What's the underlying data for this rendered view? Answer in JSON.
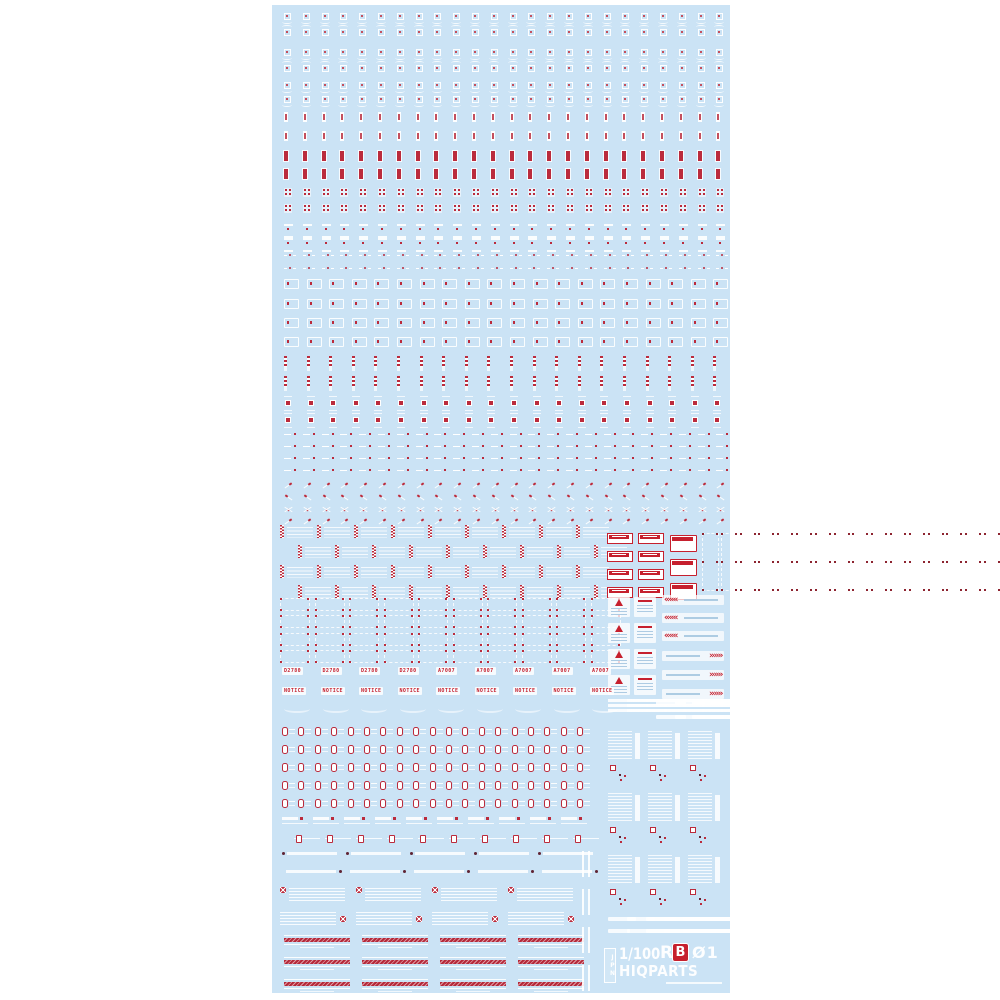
{
  "product": {
    "scale": "1/100",
    "series_r": "R",
    "series_b": "B",
    "number": "Ø1",
    "brand": "HIQPARTS",
    "region": "JPN"
  },
  "palette": {
    "page_bg": "#ffffff",
    "sheet_bg": "#cbe3f5",
    "caution_red": "#bb2b3c",
    "plate_red": "#c6202e",
    "halftone_pink": "#dd9aa2",
    "dark_dot": "#5f2433",
    "decal_white": "#ffffff"
  },
  "part_labels": {
    "code_1": "D2780",
    "code_2": "A7007",
    "notice": "NOTICE"
  },
  "decal_rows": [
    {
      "t": "tA",
      "y": 8
    },
    {
      "t": "tB",
      "y": 24
    },
    {
      "t": "tA",
      "y": 44
    },
    {
      "t": "tB",
      "y": 60
    },
    {
      "t": "tA",
      "y": 77
    },
    {
      "t": "tA",
      "y": 91
    },
    {
      "t": "tBar",
      "y": 107
    },
    {
      "t": "tBar",
      "y": 126
    },
    {
      "t": "tRedBar",
      "y": 146
    },
    {
      "t": "tRedBar",
      "y": 164
    },
    {
      "t": "tQuad",
      "y": 183
    },
    {
      "t": "tQuad",
      "y": 199
    },
    {
      "t": "tBand",
      "y": 219
    },
    {
      "t": "tBand",
      "y": 233
    },
    {
      "t": "tDotWing",
      "y": 248
    },
    {
      "t": "tDotWing",
      "y": 261
    },
    {
      "t": "tBoxTick",
      "y": 274,
      "n": 20,
      "dx": 22.6
    },
    {
      "t": "tBoxTick",
      "y": 294,
      "n": 20,
      "dx": 22.6
    },
    {
      "t": "tBoxTick",
      "y": 313,
      "n": 20,
      "dx": 22.6
    },
    {
      "t": "tBoxTick",
      "y": 332,
      "n": 20,
      "dx": 22.6
    },
    {
      "t": "tZig",
      "y": 351,
      "n": 20,
      "dx": 22.6
    },
    {
      "t": "tZig",
      "y": 371,
      "n": 20,
      "dx": 22.6
    },
    {
      "t": "tRedSq",
      "y": 391,
      "n": 20,
      "dx": 22.6
    },
    {
      "t": "tRedSq",
      "y": 408,
      "n": 20,
      "dx": 22.6
    },
    {
      "t": "tDashDot",
      "y": 427
    },
    {
      "t": "tDashDot",
      "y": 439
    },
    {
      "t": "tDashDot",
      "y": 451
    },
    {
      "t": "tDashDot",
      "y": 463
    },
    {
      "t": "tSlash",
      "y": 477
    },
    {
      "t": "tSlash2",
      "y": 489
    },
    {
      "t": "tX",
      "y": 501
    },
    {
      "t": "tSlash",
      "y": 513
    },
    {
      "t": "caution",
      "x": 8,
      "y": 520,
      "n": 9,
      "dx": 37
    },
    {
      "t": "caution",
      "x": 26,
      "y": 540,
      "n": 9,
      "dx": 37
    },
    {
      "t": "caution",
      "x": 8,
      "y": 560,
      "n": 9,
      "dx": 37
    },
    {
      "t": "caution",
      "x": 26,
      "y": 580,
      "n": 9,
      "dx": 37
    },
    {
      "t": "plateS",
      "x": 335,
      "y": 528,
      "n": 4,
      "dy": 18
    },
    {
      "t": "plateS",
      "x": 366,
      "y": 528,
      "n": 4,
      "dy": 18
    },
    {
      "t": "plateL",
      "x": 398,
      "y": 530,
      "n": 3,
      "dy": 24
    },
    {
      "t": "dframeV",
      "x": 430,
      "y": 528
    },
    {
      "t": "dframe",
      "x": 8,
      "y": 593,
      "n": 10,
      "dx": 34.5
    },
    {
      "t": "dframe",
      "x": 8,
      "y": 610,
      "n": 10,
      "dx": 34.5
    },
    {
      "t": "dframe",
      "x": 8,
      "y": 628,
      "n": 10,
      "dx": 34.5
    },
    {
      "t": "dframe",
      "x": 8,
      "y": 645,
      "n": 10,
      "dx": 34.5
    },
    {
      "t": "triPanel",
      "x": 336,
      "y": 592,
      "n": 4,
      "dy": 26
    },
    {
      "t": "linePanel",
      "x": 362,
      "y": 592,
      "n": 4,
      "dy": 26
    },
    {
      "t": "chevL",
      "x": 390,
      "y": 590,
      "n": 3,
      "dy": 18
    },
    {
      "t": "chevR",
      "x": 390,
      "y": 646,
      "n": 3,
      "dy": 19
    },
    {
      "t": "labelR",
      "x": 10,
      "y": 662,
      "n": 9,
      "dx": 38.5,
      "texts": [
        "D2780",
        "D2780",
        "D2780",
        "D2780",
        "A7007",
        "A7007",
        "A7007",
        "A7007",
        "A7007"
      ]
    },
    {
      "t": "labelR",
      "x": 10,
      "y": 682,
      "n": 9,
      "dx": 38.5,
      "texts": [
        "NOTICE",
        "NOTICE",
        "NOTICE",
        "NOTICE",
        "NOTICE",
        "NOTICE",
        "NOTICE",
        "NOTICE",
        "NOTICE"
      ]
    },
    {
      "t": "swoosh",
      "x": 12,
      "y": 700,
      "n": 9,
      "dx": 38.5
    },
    {
      "t": "bars3",
      "x": 336,
      "y": 694
    },
    {
      "t": "strip",
      "x": 384,
      "y": 696,
      "w": 30
    },
    {
      "t": "strip",
      "x": 384,
      "y": 710,
      "w": 30
    },
    {
      "t": "strip",
      "x": 420,
      "y": 696,
      "w": 26
    },
    {
      "t": "strip",
      "x": 420,
      "y": 710,
      "w": 26
    },
    {
      "t": "pill",
      "x": 10,
      "y": 722,
      "n": 19,
      "dx": 16.4
    },
    {
      "t": "pill",
      "x": 10,
      "y": 740,
      "n": 19,
      "dx": 16.4
    },
    {
      "t": "pill",
      "x": 10,
      "y": 758,
      "n": 19,
      "dx": 16.4
    },
    {
      "t": "pill",
      "x": 10,
      "y": 776,
      "n": 19,
      "dx": 16.4
    },
    {
      "t": "pill",
      "x": 10,
      "y": 794,
      "n": 19,
      "dx": 16.4
    },
    {
      "t": "tag",
      "x": 10,
      "y": 812,
      "n": 10,
      "dx": 31
    },
    {
      "t": "tag2",
      "x": 22,
      "y": 830,
      "n": 10,
      "dx": 31
    },
    {
      "t": "stripDot",
      "x": 10,
      "y": 846,
      "n": 5,
      "dx": 64
    },
    {
      "t": "stripDotR",
      "x": 14,
      "y": 864,
      "n": 5,
      "dx": 64
    },
    {
      "t": "txX",
      "x": 8,
      "y": 882,
      "n": 4,
      "dx": 76
    },
    {
      "t": "txXR",
      "x": 8,
      "y": 906,
      "n": 4,
      "dx": 76
    },
    {
      "t": "hatch",
      "x": 12,
      "y": 930,
      "n": 4,
      "dx": 78
    },
    {
      "t": "hatch",
      "x": 12,
      "y": 952,
      "n": 4,
      "dx": 78
    },
    {
      "t": "hatch",
      "x": 12,
      "y": 974,
      "n": 4,
      "dx": 78
    },
    {
      "t": "vdash",
      "x": 310,
      "y": 846,
      "n": 4,
      "dy": 38
    },
    {
      "t": "rtext",
      "x": 336,
      "y": 726,
      "n": 3,
      "dx": 40
    },
    {
      "t": "rtext",
      "x": 336,
      "y": 788,
      "n": 3,
      "dx": 40
    },
    {
      "t": "rtext",
      "x": 336,
      "y": 850,
      "n": 3,
      "dx": 40
    },
    {
      "t": "strip",
      "x": 336,
      "y": 912,
      "w": 28
    },
    {
      "t": "strip",
      "x": 376,
      "y": 912,
      "w": 28
    },
    {
      "t": "strip",
      "x": 416,
      "y": 912,
      "w": 28
    },
    {
      "t": "strip",
      "x": 336,
      "y": 924,
      "w": 22
    },
    {
      "t": "strip",
      "x": 376,
      "y": 924,
      "w": 22
    },
    {
      "t": "strip",
      "x": 416,
      "y": 924,
      "w": 22
    }
  ]
}
